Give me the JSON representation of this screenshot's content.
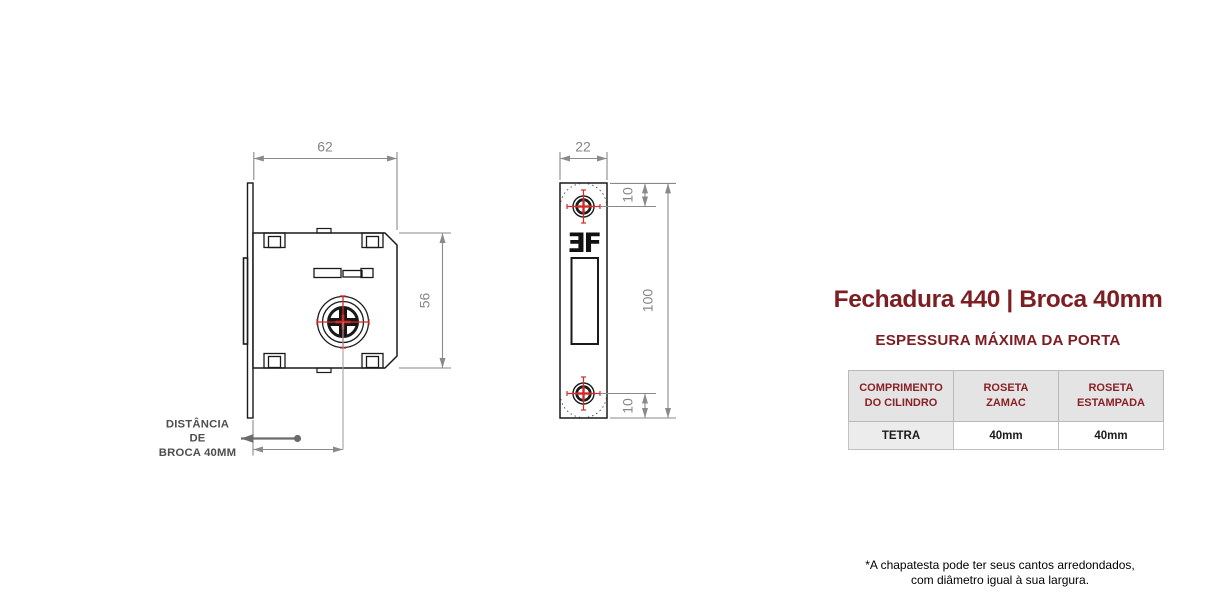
{
  "side_view": {
    "width_dim": "62",
    "height_dim": "56",
    "drill_label": [
      "DISTÂNCIA",
      "DE",
      "BROCA 40MM"
    ]
  },
  "front_view": {
    "width_dim": "22",
    "height_dim": "100",
    "top_hole_dim": "10",
    "bottom_hole_dim": "10",
    "logo": "ƎF"
  },
  "panel": {
    "title": "Fechadura 440 | Broca 40mm",
    "subtitle": "ESPESSURA MÁXIMA DA PORTA",
    "table": {
      "headers": [
        {
          "line1": "COMPRIMENTO",
          "line2": "DO CILINDRO"
        },
        {
          "line1": "ROSETA",
          "line2": "ZAMAC"
        },
        {
          "line1": "ROSETA",
          "line2": "ESTAMPADA"
        }
      ],
      "row": [
        "TETRA",
        "40mm",
        "40mm"
      ]
    },
    "footnote": [
      "*A chapatesta pode ter seus cantos arredondados,",
      "com diâmetro igual à sua largura."
    ]
  },
  "colors": {
    "accent_maroon": "#7d1e23",
    "table_header_text": "#8a2126",
    "table_header_bg": "#e4e4e4",
    "table_row_shade_bg": "#ececec",
    "drawing_line": "#1a1a1a",
    "dimension_gray": "#868686",
    "crosshair_red": "#d22a26"
  }
}
